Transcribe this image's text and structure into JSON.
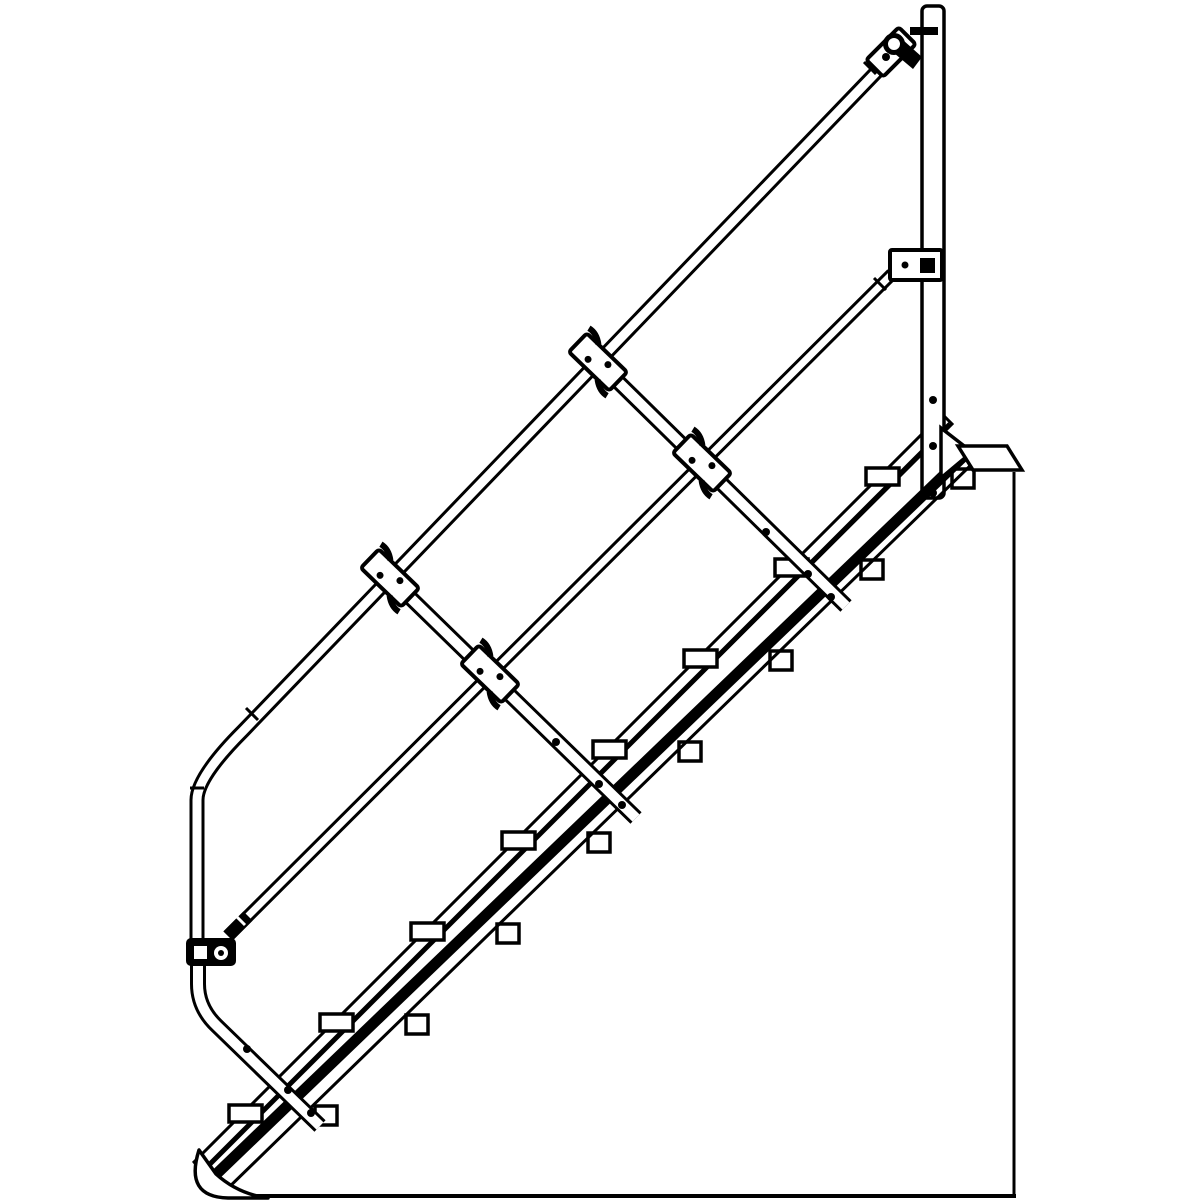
{
  "meta": {
    "title": "Technical line drawing: modular industrial stair with guardrail, side elevation",
    "background_color": "#ffffff",
    "line_color": "#000000"
  },
  "diagram": {
    "type": "technical-illustration",
    "view": "side-elevation",
    "subject": "45-degree modular stair with handrail, knee rail, clamp fittings and platform connection",
    "incline_degrees": 45,
    "step_count": 8,
    "stringer_count": 2,
    "baluster_count": 4,
    "mid_clamp_count": 4,
    "end_clamp_count": 3,
    "components": [
      "handrail-top-rail",
      "knee-rail",
      "handrail-post",
      "handrail-post-cap",
      "baluster",
      "clamp-fitting",
      "near-stringer",
      "far-stringer",
      "tread",
      "stringer-foot",
      "platform-bracket",
      "gusset-plate",
      "platform-wall-edge",
      "ground-line",
      "bolt"
    ]
  },
  "steps": {
    "count": 8,
    "dx": 91,
    "dy": -91,
    "left_tab": {
      "x0": 229,
      "y0": 1105,
      "w": 33,
      "h": 17
    },
    "right_tab": {
      "x0": 315,
      "y0": 1106,
      "w": 22,
      "h": 19
    }
  },
  "bolts": {
    "baluster_upper": [
      [
        766,
        532
      ],
      [
        808,
        574
      ],
      [
        831,
        597
      ]
    ],
    "baluster_lower": [
      [
        556,
        742
      ],
      [
        599,
        784
      ],
      [
        622,
        805
      ]
    ],
    "baluster_bottom": [
      [
        247,
        1049
      ],
      [
        288,
        1090
      ],
      [
        311,
        1113
      ]
    ],
    "post": [
      [
        933,
        400
      ],
      [
        933,
        446
      ],
      [
        933,
        493
      ]
    ]
  },
  "clamps": {
    "mid_positions": [
      [
        390,
        578
      ],
      [
        490,
        674
      ],
      [
        598,
        362
      ],
      [
        702,
        463
      ]
    ]
  }
}
